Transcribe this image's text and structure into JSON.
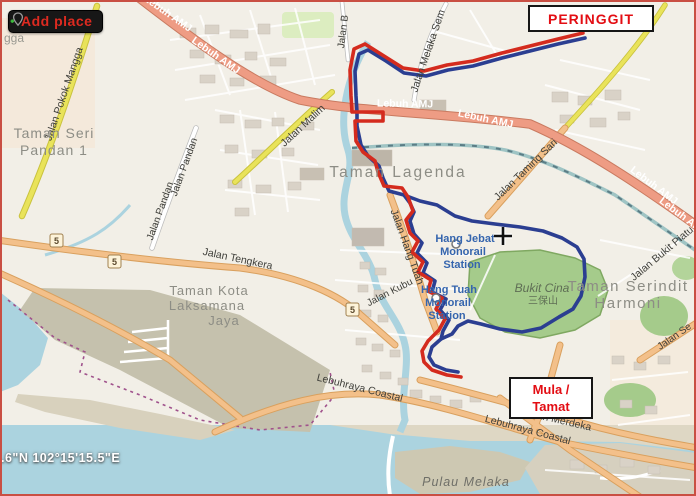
{
  "toolbar": {
    "add_place_label": "Add place"
  },
  "markers": {
    "end_box": "PERINGGIT",
    "start_box_line1": "Mula /",
    "start_box_line2": "Tamat"
  },
  "status": {
    "coordinates": ".6\"N 102°15'15.5\"E"
  },
  "map": {
    "places": {
      "taman_seri_pandan_l1": "Taman Seri",
      "taman_seri_pandan_l2": "Pandan 1",
      "taman_lagenda": "Taman Lagenda",
      "taman_kota_l1": "Taman Kota",
      "taman_kota_l2": "Laksamana",
      "taman_kota_l3": "Jaya",
      "taman_serindit_l1": "Taman Serindit",
      "taman_serindit_l2": "Harmoni",
      "bukit_cina": "Bukit Cina",
      "bukit_cina_cjk": "三保山",
      "pulau_melaka": "Pulau Melaka",
      "mangga_fragment": "gga"
    },
    "stations": {
      "hang_jebat": "Hang Jebat",
      "hang_tuah": "Hang Tuah",
      "monorail": "Monorail",
      "station": "Station"
    },
    "roads": {
      "lebuh_amj": "Lebuh AMJ",
      "jalan_pokok_mangga": "Jalan Pokok Mangga",
      "jalan_pandan": "Jalan Pandan",
      "jalan_malim": "Jalan Malim",
      "jalan_tengkera": "Jalan Tengkera",
      "jalan_hang_tuah": "Jalan Hang Tuah",
      "jalan_kubu": "Jalan Kubu",
      "jalan_bukit_piatu": "Jalan Bukit Piatu",
      "jalan_taming_sari": "Jalan Taming Sari",
      "jalan_melaka_sem": "Jalan Melaka Sem",
      "jalan_b": "Jalan B",
      "jalan_merdeka": "Jalan Merdeka",
      "lebuhraya_coastal": "Lebuhraya Coastal",
      "jalan_se": "Jalan Se",
      "route_shield": "5"
    },
    "colors": {
      "route_outbound": "#d42b1e",
      "route_return": "#2b3e91",
      "frame": "#c94f43",
      "marker_text": "#e30d13",
      "water": "#abd3df",
      "park": "#a5cb8b",
      "trunk_road": "#ee9c84"
    }
  }
}
